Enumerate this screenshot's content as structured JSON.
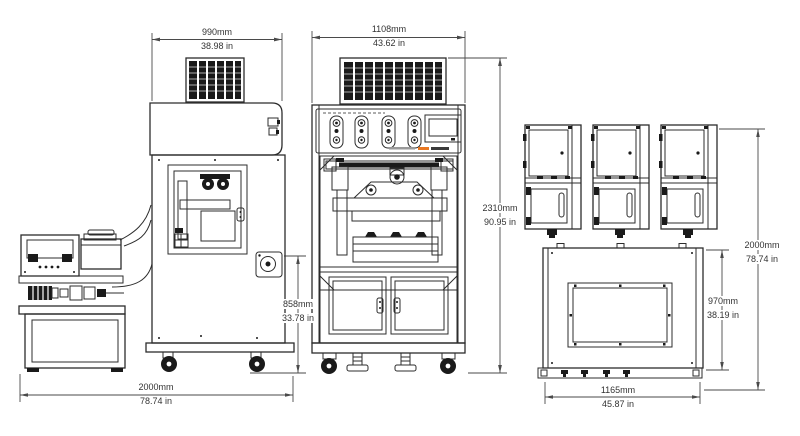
{
  "document": {
    "type": "machine dimensional drawing",
    "views": [
      "pump-cart side view",
      "machine side view",
      "machine front view",
      "door detail views",
      "plan view"
    ]
  },
  "colors": {
    "line_ink": "#2c2c2c",
    "dimension_line": "#4a4a4a",
    "text": "#333333",
    "panel_accent": "#e87722"
  },
  "dimensions": {
    "side_width": {
      "mm": "990mm",
      "inch": "38.98 in"
    },
    "front_width": {
      "mm": "1108mm",
      "inch": "43.62 in"
    },
    "total_height": {
      "mm": "2310mm",
      "inch": "90.95 in"
    },
    "bench_height": {
      "mm": "858mm",
      "inch": "33.78 in"
    },
    "overall_width": {
      "mm": "2000mm",
      "inch": "78.74 in"
    },
    "plan_depth": {
      "mm": "970mm",
      "inch": "38.19 in"
    },
    "plan_width": {
      "mm": "1165mm",
      "inch": "45.87 in"
    },
    "overall_depth": {
      "mm": "2000mm",
      "inch": "78.74 in"
    }
  }
}
